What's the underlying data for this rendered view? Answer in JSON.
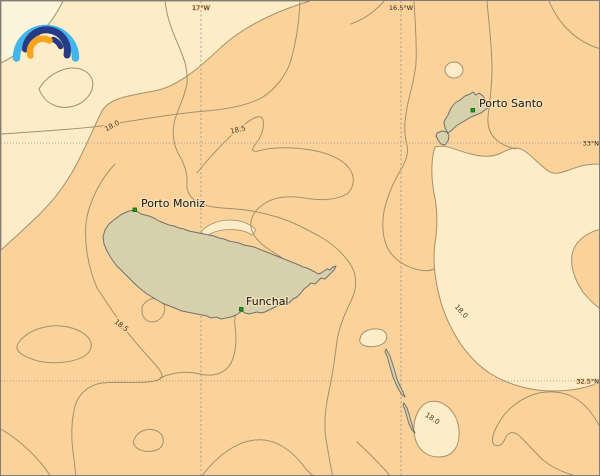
{
  "map": {
    "places": [
      {
        "name": "Porto Moniz"
      },
      {
        "name": "Funchal"
      },
      {
        "name": "Porto Santo"
      }
    ],
    "contour_labels": [
      "18.0",
      "18.5",
      "18.5",
      "18.0",
      "18.0"
    ],
    "isoline_values": [
      18.0,
      18.5
    ],
    "graticule": {
      "top": [
        "17°W",
        "16.5°W"
      ],
      "right": [
        "33°N",
        "32.5°N"
      ]
    },
    "colors": {
      "sea": "#fbd39a",
      "band_light": "#fcedc8",
      "band_lighter": "#fdf4dc",
      "land": "#d6d0ab",
      "land_outline": "#717171",
      "contour_line": "#a5906a",
      "marker_green": "#18a018",
      "logo_blue_light": "#41b6ea",
      "logo_blue_dark": "#263a85",
      "logo_orange": "#f7a51f"
    }
  }
}
